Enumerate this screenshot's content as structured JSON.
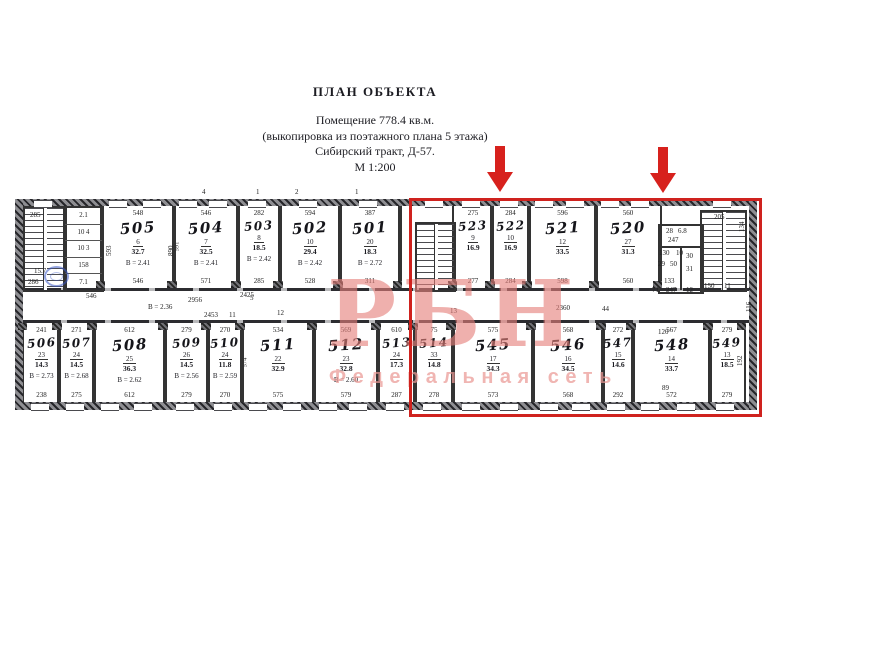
{
  "title": {
    "heading": "ПЛАН ОБЪЕКТА",
    "premises": "Помещение 778.4 кв.м.",
    "note": "(выкопировка из поэтажного плана 5 этажа)",
    "address": "Сибирский тракт, Д-57.",
    "scale": "М 1:200"
  },
  "watermark": {
    "logo": "РБН",
    "subtitle": "Федеральная сеть",
    "color": "#e5807a"
  },
  "highlight": {
    "color": "#cf221e",
    "arrow_color": "#d7211d"
  },
  "plan": {
    "rooms": [
      {
        "num": "505",
        "row": "top",
        "x": 100,
        "w": 72,
        "top": "548",
        "pos": "6",
        "area": "32.7",
        "h": "В = 2.41",
        "bottom": "546"
      },
      {
        "num": "504",
        "row": "top",
        "x": 172,
        "w": 64,
        "top": "546",
        "pos": "7",
        "area": "32.5",
        "h": "В = 2.41",
        "bottom": "571",
        "side": "591"
      },
      {
        "num": "503",
        "row": "top",
        "x": 236,
        "w": 42,
        "top": "282",
        "pos": "8",
        "area": "18.5",
        "h": "В = 2.42",
        "bottom": "285"
      },
      {
        "num": "502",
        "row": "top",
        "x": 278,
        "w": 60,
        "top": "594",
        "pos": "10",
        "area": "29.4",
        "h": "В = 2.42",
        "bottom": "528"
      },
      {
        "num": "501",
        "row": "top",
        "x": 338,
        "w": 60,
        "top": "387",
        "pos": "20",
        "area": "18.3",
        "h": "В = 2.72",
        "bottom": "311"
      },
      {
        "num": "523",
        "row": "top",
        "x": 452,
        "w": 38,
        "top": "275",
        "pos": "9",
        "area": "16.9",
        "bottom": "277"
      },
      {
        "num": "522",
        "row": "top",
        "x": 490,
        "w": 37,
        "top": "284",
        "pos": "10",
        "area": "16.9",
        "bottom": "284"
      },
      {
        "num": "521",
        "row": "top",
        "x": 527,
        "w": 67,
        "top": "596",
        "pos": "12",
        "area": "33.5",
        "bottom": "598"
      },
      {
        "num": "520",
        "row": "top",
        "x": 594,
        "w": 64,
        "top": "560",
        "pos": "27",
        "area": "31.3",
        "bottom": "560"
      },
      {
        "num": "506",
        "row": "bottom",
        "x": 22,
        "w": 35,
        "top": "241",
        "pos": "23",
        "area": "14.3",
        "h": "В = 2.73",
        "bottom": "238"
      },
      {
        "num": "507",
        "row": "bottom",
        "x": 57,
        "w": 35,
        "top": "271",
        "pos": "24",
        "area": "14.5",
        "h": "В = 2.68",
        "bottom": "275"
      },
      {
        "num": "508",
        "row": "bottom",
        "x": 92,
        "w": 71,
        "top": "612",
        "pos": "25",
        "area": "36.3",
        "h": "В = 2.62",
        "bottom": "612"
      },
      {
        "num": "509",
        "row": "bottom",
        "x": 163,
        "w": 43,
        "top": "279",
        "pos": "26",
        "area": "14.5",
        "h": "В = 2.56",
        "bottom": "279"
      },
      {
        "num": "510",
        "row": "bottom",
        "x": 206,
        "w": 34,
        "top": "270",
        "pos": "24",
        "area": "11.8",
        "h": "В = 2.59",
        "bottom": "270"
      },
      {
        "num": "511",
        "row": "bottom",
        "x": 240,
        "w": 72,
        "top": "534",
        "pos": "22",
        "area": "32.9",
        "bottom": "575",
        "side": "574"
      },
      {
        "num": "512",
        "row": "bottom",
        "x": 312,
        "w": 64,
        "top": "569",
        "pos": "23",
        "area": "32.8",
        "h": "В = 2.60",
        "bottom": "579"
      },
      {
        "num": "513",
        "row": "bottom",
        "x": 376,
        "w": 37,
        "top": "610",
        "pos": "24",
        "area": "17.3",
        "bottom": "287"
      },
      {
        "num": "514",
        "row": "bottom",
        "x": 413,
        "w": 38,
        "top": "75",
        "pos": "33",
        "area": "14.8",
        "bottom": "278"
      },
      {
        "num": "545",
        "row": "bottom",
        "x": 451,
        "w": 80,
        "top": "575",
        "pos": "17",
        "area": "34.3",
        "bottom": "573"
      },
      {
        "num": "546",
        "row": "bottom",
        "x": 531,
        "w": 70,
        "top": "568",
        "pos": "16",
        "area": "34.5",
        "bottom": "568"
      },
      {
        "num": "547",
        "row": "bottom",
        "x": 601,
        "w": 30,
        "top": "272",
        "pos": "15",
        "area": "14.6",
        "bottom": "292"
      },
      {
        "num": "548",
        "row": "bottom",
        "x": 631,
        "w": 77,
        "top": "567",
        "pos": "14",
        "area": "33.7",
        "bottom": "572"
      },
      {
        "num": "549",
        "row": "bottom",
        "x": 708,
        "w": 34,
        "top": "279",
        "pos": "13",
        "area": "18.5",
        "bottom": "279"
      }
    ],
    "stairs": [
      {
        "name": "stair-left",
        "x": 23,
        "y": 206,
        "w": 40,
        "h": 82
      },
      {
        "name": "stair-mid",
        "x": 415,
        "y": 222,
        "w": 37,
        "h": 66
      },
      {
        "name": "stair-right",
        "x": 700,
        "y": 210,
        "w": 43,
        "h": 78
      }
    ],
    "storage": {
      "x": 63,
      "y": 206,
      "w": 37,
      "h": 82,
      "rows": [
        "2.1",
        "10 4",
        "10 3",
        "158",
        "7.1"
      ]
    },
    "wc_block": {
      "x": 658,
      "y": 224,
      "w": 42,
      "h": 66
    },
    "annotations": [
      {
        "t": "285",
        "x": 30,
        "y": 212
      },
      {
        "t": "15.7",
        "x": 34,
        "y": 268
      },
      {
        "t": "286",
        "x": 28,
        "y": 279
      },
      {
        "t": "546",
        "x": 86,
        "y": 293
      },
      {
        "t": "5",
        "x": 250,
        "y": 295
      },
      {
        "t": "2956",
        "x": 188,
        "y": 297
      },
      {
        "t": "2425",
        "x": 240,
        "y": 292
      },
      {
        "t": "В = 2.36",
        "x": 148,
        "y": 304
      },
      {
        "t": "2453",
        "x": 204,
        "y": 312
      },
      {
        "t": "11",
        "x": 229,
        "y": 312
      },
      {
        "t": "12",
        "x": 277,
        "y": 310
      },
      {
        "t": "13",
        "x": 450,
        "y": 308
      },
      {
        "t": "2360",
        "x": 556,
        "y": 305
      },
      {
        "t": "44",
        "x": 602,
        "y": 306
      },
      {
        "t": "4",
        "x": 202,
        "y": 189
      },
      {
        "t": "1",
        "x": 256,
        "y": 189
      },
      {
        "t": "2",
        "x": 295,
        "y": 189
      },
      {
        "t": "1",
        "x": 355,
        "y": 189
      },
      {
        "t": "205",
        "x": 714,
        "y": 214
      },
      {
        "t": "150",
        "x": 704,
        "y": 283
      },
      {
        "t": "11",
        "x": 724,
        "y": 283
      },
      {
        "t": "28",
        "x": 666,
        "y": 228
      },
      {
        "t": "6.8",
        "x": 678,
        "y": 228
      },
      {
        "t": "247",
        "x": 668,
        "y": 237
      },
      {
        "t": "130",
        "x": 659,
        "y": 250
      },
      {
        "t": "10",
        "x": 676,
        "y": 250
      },
      {
        "t": "29",
        "x": 658,
        "y": 261
      },
      {
        "t": "50",
        "x": 670,
        "y": 261
      },
      {
        "t": "30",
        "x": 686,
        "y": 253
      },
      {
        "t": "31",
        "x": 686,
        "y": 266
      },
      {
        "t": "133",
        "x": 664,
        "y": 278
      },
      {
        "t": "71",
        "x": 652,
        "y": 287
      },
      {
        "t": "247",
        "x": 666,
        "y": 287
      },
      {
        "t": "12",
        "x": 686,
        "y": 287
      },
      {
        "t": "120",
        "x": 658,
        "y": 329
      },
      {
        "t": "89",
        "x": 662,
        "y": 385
      },
      {
        "t": "134",
        "x": 739,
        "y": 232,
        "r": 1
      },
      {
        "t": "116",
        "x": 746,
        "y": 312,
        "r": 1
      },
      {
        "t": "192",
        "x": 737,
        "y": 366,
        "r": 1
      },
      {
        "t": "593",
        "x": 106,
        "y": 256,
        "r": 1
      },
      {
        "t": "890",
        "x": 168,
        "y": 256,
        "r": 1
      }
    ]
  }
}
